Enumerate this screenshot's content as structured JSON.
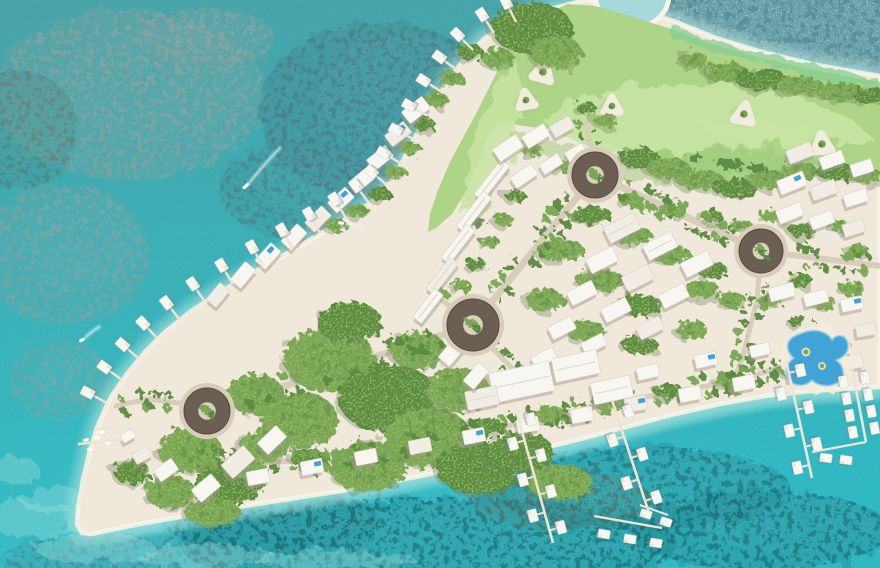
{
  "scene": {
    "kind": "aerial-masterplan-rendering",
    "setting": "tropical-island-resort-with-golf-course"
  },
  "features": {
    "roundabout_count": 4,
    "northwest_overwater_villa_count": 21,
    "south_villa_pier_count": 5,
    "golf_bunker_islet_count": 5,
    "boat_count": 3,
    "lagoon_pool_count": 1
  },
  "palette": {
    "water": "#47a7ac",
    "water2": "#35b6c0",
    "waterTR": "#6aa0aa",
    "speckleLight": "#bcd6d5",
    "speckleDarkTR": "#48808c",
    "shallow": "#a9e4de",
    "shallow2": "#cdeee8",
    "reefGray": "#87a4a1",
    "reefDark": "#4a7d87",
    "reefDeep": "#1e6f78",
    "reefOlive": "#527a70",
    "fineNoise": "#1f7f88",
    "sand": "#f0e8da",
    "beachHi": "#f9f4e9",
    "walkway": "#f3ecdd",
    "road": "#d8cdbb",
    "roundabout": "#6b5e53",
    "roundaboutInner": "#dbd1bf",
    "roundRim": "#57493f",
    "golf": "#aed488",
    "golfLight": "#c8e5a3",
    "golfDark": "#9ac878",
    "golfBright": "#86cf92",
    "treeMid": "#7aa654",
    "treeDark": "#5b8a40",
    "treeLight": "#9cbf6b",
    "bush": "#4e7d3e",
    "bunker": "#f2ecdf",
    "bldg": "#f8f6f1",
    "bldg2": "#f1ede5",
    "bldgShadow": "#a59c8e",
    "bldgEdge": "#d8d2c6",
    "pool": "#42a3d6",
    "poolLight": "#8ecbe8",
    "poolDeck": "#f4ecdc",
    "pierWood": "#eee4d4",
    "villaShadow": "#5e8f96",
    "lagoon": "#a7d9dc",
    "boat": "#ffffff",
    "wake": "#e8f6f4",
    "treeShadow": "#74855f"
  }
}
